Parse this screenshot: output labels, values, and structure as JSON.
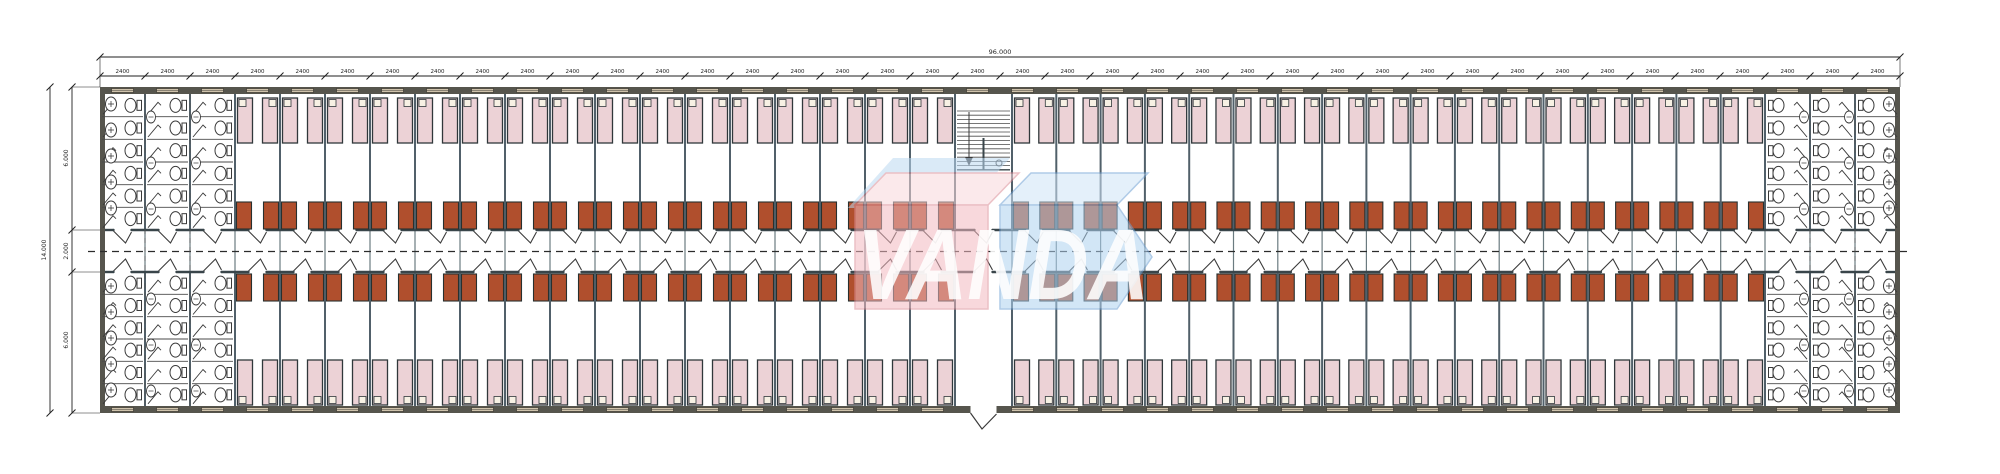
{
  "plan": {
    "type": "dormitory floor plan",
    "watermark": {
      "text": "VANDA",
      "pink": "#f3b9c0",
      "pink_top": "#f8d8dc",
      "blue": "#aed2f0",
      "blue_top": "#cfe4f6",
      "blue_back": "#bcd9f2",
      "stroke_pink": "#dc8d97",
      "stroke_blue": "#6fa1d4",
      "text_color": "#ffffff"
    },
    "dimensions": {
      "module_label": "2400",
      "module_count": 40,
      "total_width_label": "96.000",
      "height_total_label": "14.000",
      "height_segment_labels": [
        "6.000",
        "2.000",
        "6.000"
      ]
    },
    "layout": {
      "bath_modules_each_end": 3,
      "rooms_left_section": 16,
      "rooms_right_section": 17,
      "beds_per_room": 2,
      "cabinets_per_room": 2,
      "stalls_per_bath_column_per_wing": 6,
      "sinks_per_outer_wall_per_wing": 5,
      "wings": [
        "top",
        "bottom"
      ],
      "stair_flights": 2,
      "entrance_location": "center-bottom"
    },
    "colors": {
      "paper": "#ffffff",
      "wall_fill": "#56554d",
      "window_fill": "#cfc3ac",
      "window_frame": "#45413a",
      "partition": "#51606a",
      "corridor_wall": "#39454a",
      "corridor_axis": "#6b7b80",
      "bed_fill": "#ecd2d6",
      "bed_stroke": "#30383b",
      "pillow_fill": "#f7f1e4",
      "cabinet_fill": "#b04f2d",
      "cabinet_stroke": "#28302f",
      "fixture_stroke": "#3a3a3a",
      "stall_line": "#4a4a4a",
      "dim_line": "#1f1f1f",
      "centerline": "#2b2b2b"
    }
  }
}
